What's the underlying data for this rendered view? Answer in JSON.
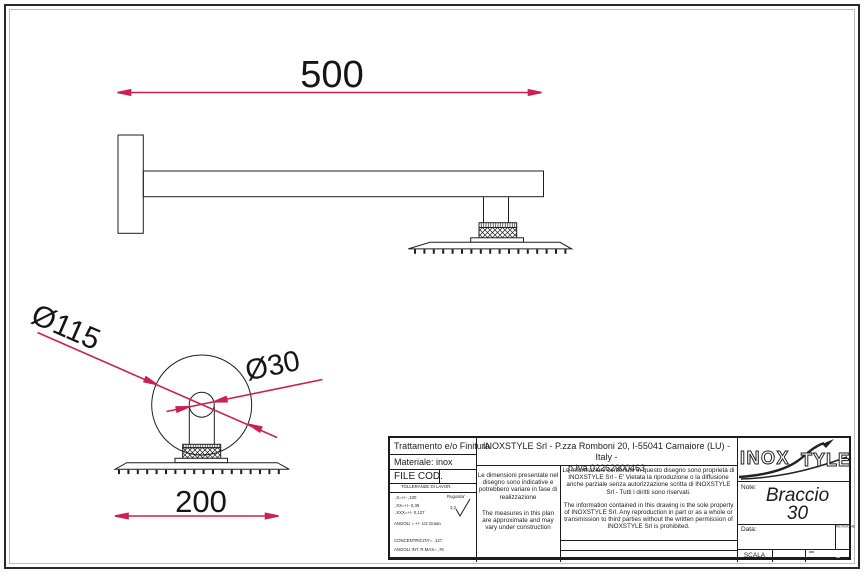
{
  "colors": {
    "line": "#1f1f1f",
    "dimension_red": "#cc2150",
    "background": "#ffffff"
  },
  "drawing": {
    "description": "Technical drawing, wall-mounted shower arm with square shower head",
    "dimensions": {
      "arm_length": "500",
      "head_width": "200",
      "wall_plate_diameter": "Ø115",
      "arm_tube_diameter": "Ø30"
    }
  },
  "title_block": {
    "treatment_label": "Trattamento e/o Finitura",
    "material_label": "Materiale: inox",
    "file_cod_label": "FILE COD.",
    "tolerances_header": "TOLLERANZE DI LAVOR.",
    "tolerances": [
      ",X=+/- ,100",
      ",XX=+/- 0,36",
      ",XXX=+/- 0,127"
    ],
    "angles_tolerance": "ANGOLI = +/- 1/2 Grado",
    "concentricity": "CONCENTRICITA'= ,127",
    "internal_angles": "ANGOLI INT. R.MAX= ,76",
    "roughness_label": "Rugosita'",
    "roughness_value": "3,2",
    "company_header_line1": "INOXSTYLE Srl - P.zza Romboni 20, I-55041 Camaiore (LU) - Italy -",
    "company_header_line2": "p.Iva 02262900463",
    "info_it": "Le dimensioni presentate nel disegno sono indicative e potrebbero variare in fase di realizzazione",
    "info_en": "The measures in this plan are approximate and may vary under construction",
    "disclaimer_it": "Le informazioni contenute in questo disegno sono proprietà di INOXSTYLE Srl - E' Vietata la riproduzione o la diffusione anche parziale senza autorizzazione scritta di INOXSTYLE Srl - Tutti i diritti sono riservati.",
    "disclaimer_en": "The information contained in this drawing is the sole property of INOXSTYLE Srl. Any reproduction in part or as a whole or transmission to third parties without the written permission of INOXSTYLE Srl is prohibited.",
    "logo_part1": "INOX",
    "logo_part2": "TYLE",
    "note_label": "Note:",
    "note_value_line1": "Braccio",
    "note_value_line2": "30",
    "date_label": "Data:",
    "revision_label": "REVISIONE",
    "scale_label": "SCALA"
  }
}
